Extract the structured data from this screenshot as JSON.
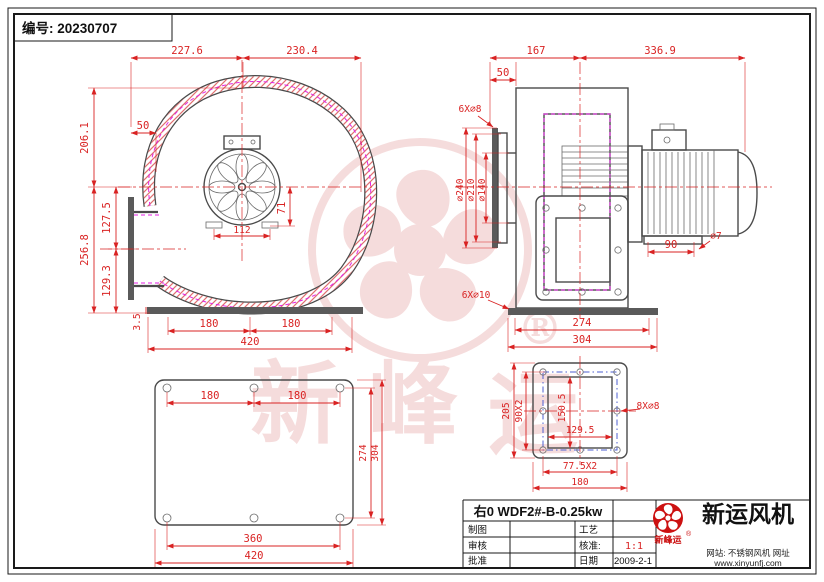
{
  "header": {
    "doc_no": "编号: 20230707"
  },
  "front_view": {
    "dim_top_left": "227.6",
    "dim_top_right": "230.4",
    "dim_offset_50": "50",
    "dim_height_upper": "206.1",
    "dim_height_lower": "256.8",
    "dim_outlet_upper": "127.5",
    "dim_outlet_lower": "129.3",
    "dim_plate_thk": "3.5",
    "dim_hub_v": "71",
    "dim_hub_h": "112",
    "dim_base_left": "180",
    "dim_base_right": "180",
    "dim_base_total": "420"
  },
  "side_view": {
    "dim_top_left": "167",
    "dim_top_right": "336.9",
    "dim_offset_50": "50",
    "note_inlet_holes": "6X∅8",
    "dia_outer": "∅240",
    "dia_mid": "∅210",
    "dia_inner": "∅140",
    "dim_motor_feet": "90",
    "dia_foot_hole": "∅7",
    "note_base_holes": "6X∅10",
    "dim_base_inner": "274",
    "dim_base_outer": "304"
  },
  "base_view": {
    "dim_top_left": "180",
    "dim_top_right": "180",
    "dim_side_inner": "274",
    "dim_side_outer": "304",
    "dim_bottom_inner": "360",
    "dim_bottom_outer": "420"
  },
  "flange_view": {
    "dim_height_outer": "205",
    "dim_height_holes": "90X2",
    "dim_opening_h": "150.5",
    "dim_opening_w": "129.5",
    "dim_width_holes": "77.5X2",
    "dim_width_outer": "180",
    "note_holes": "8X∅8"
  },
  "title_block": {
    "model": "右0 WDF2#-B-0.25kw",
    "r1c1": "制图",
    "r1c3": "工艺",
    "r2c1": "审核",
    "r2c3": "核准:",
    "r2c4": "1:1",
    "r3c1": "批准",
    "r3c3": "日期",
    "r3c4": "2009-2-1"
  },
  "brand": {
    "name": "新运风机",
    "logo_caption": "新峰运",
    "registered": "®",
    "site_line1": "网站: 不锈钢风机 网址",
    "site_line2": "www.xinyunfj.com"
  },
  "watermark": {
    "ch1": "新",
    "ch2": "峰",
    "ch3": "运",
    "registered": "®"
  },
  "colors": {
    "dimension_red": "#d92323",
    "hatch_red": "#e07070",
    "outline_gray": "#4a4a4a",
    "liner_magenta": "#e422e4",
    "bolt_blue": "#4d5fd0",
    "brand_red": "#cc1111",
    "watermark_pink": "#e08f8f"
  }
}
